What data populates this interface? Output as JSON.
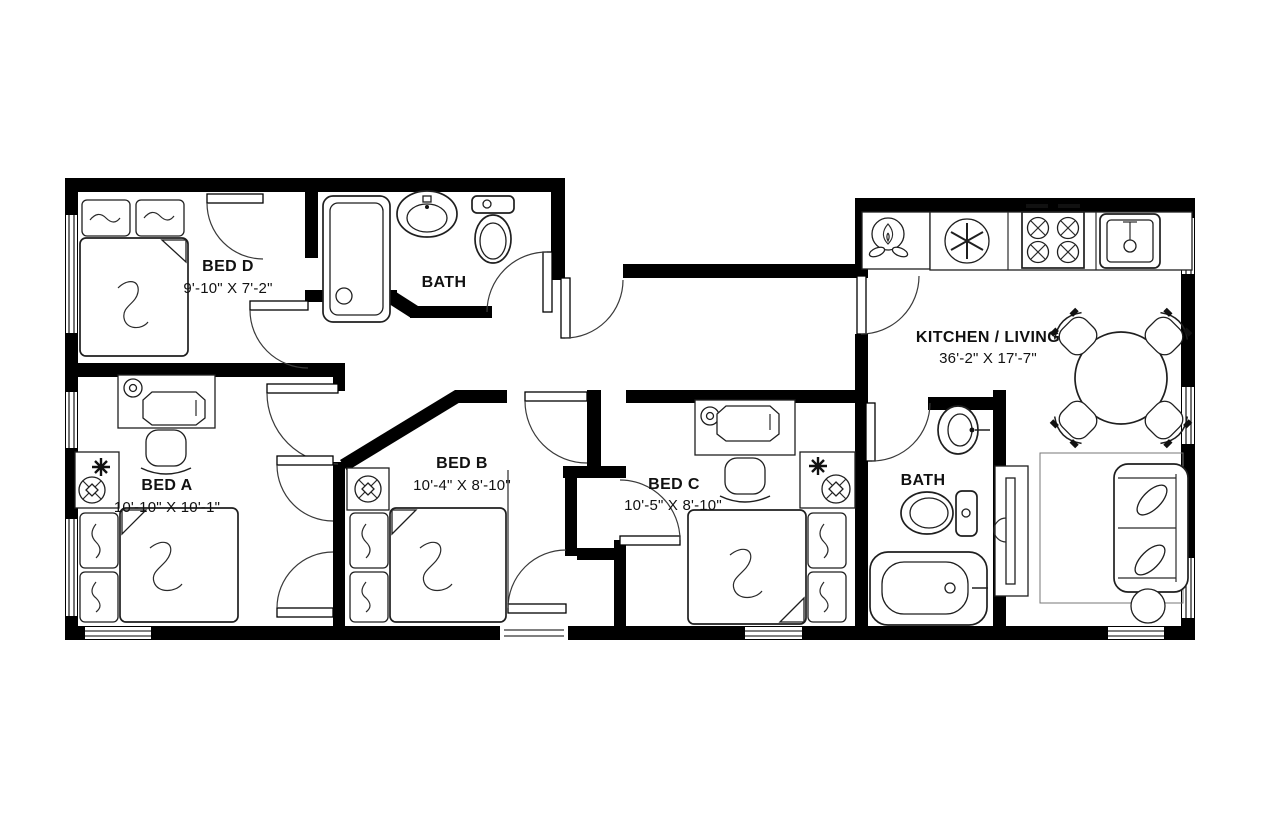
{
  "plan": {
    "rooms": [
      {
        "id": "bed_d",
        "name": "BED D",
        "dims": "9'-10\" X 7'-2\"",
        "fixtures": [
          "double-bed",
          "pillows"
        ]
      },
      {
        "id": "bath_top",
        "name": "BATH",
        "fixtures": [
          "shower",
          "pedestal-sink",
          "toilet"
        ]
      },
      {
        "id": "bed_a",
        "name": "BED A",
        "dims": "10'-10\" X 10'-1\"",
        "fixtures": [
          "desk",
          "desk-chair",
          "desk-lamp",
          "side-table",
          "plant",
          "ceiling-fan-light",
          "double-bed",
          "closet-double-doors"
        ]
      },
      {
        "id": "bed_b",
        "name": "BED B",
        "dims": "10'-4\" X 8'-10\"",
        "fixtures": [
          "side-table",
          "ceiling-fan-light",
          "double-bed"
        ]
      },
      {
        "id": "bed_c",
        "name": "BED C",
        "dims": "10'-5\" X 8'-10\"",
        "fixtures": [
          "desk",
          "desk-chair",
          "desk-lamp",
          "side-table",
          "plant",
          "ceiling-fan-light",
          "double-bed"
        ]
      },
      {
        "id": "bath_right",
        "name": "BATH",
        "fixtures": [
          "pedestal-sink",
          "toilet",
          "bathtub"
        ]
      },
      {
        "id": "kitchen_living",
        "name": "KITCHEN / LIVING",
        "dims": "36'-2\" X 17'-7\"",
        "fixtures": [
          "water-heater",
          "refrigerator",
          "range-stove",
          "vent-hood",
          "kitchen-sink",
          "counter",
          "dining-table",
          "dining-chairs",
          "tv-console",
          "tv",
          "rug",
          "sofa",
          "round-side-table"
        ]
      }
    ]
  },
  "colors": {
    "wall": "#000000",
    "furniture_line": "#1f1f1f",
    "background": "#ffffff",
    "label_text": "#111111"
  }
}
